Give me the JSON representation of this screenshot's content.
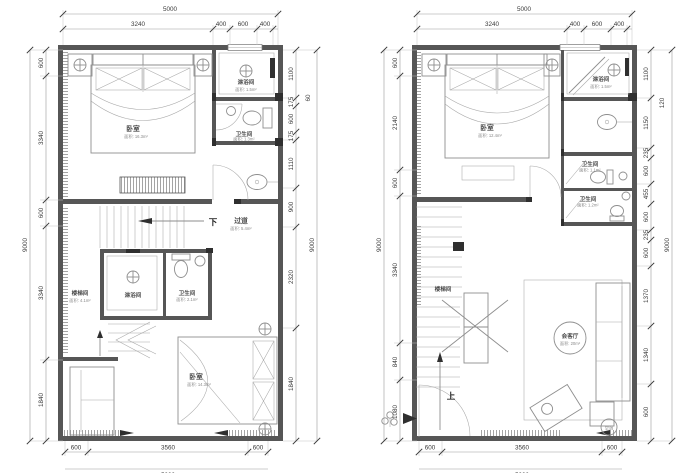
{
  "colors": {
    "wall": "#565656",
    "line": "#8e8e8e",
    "dim_text": "#3a3a3a",
    "background": "#ffffff"
  },
  "left_plan": {
    "dims": {
      "top_total": "5000",
      "top_chain": [
        "3240",
        "400",
        "600",
        "400"
      ],
      "left_total": "9000",
      "left_chain": [
        "600",
        "3340",
        "600",
        "3340",
        "1840"
      ],
      "right_total": "9000",
      "right_wall": "60",
      "right_chain": [
        "1100",
        "175",
        "600",
        "175",
        "1110",
        "900",
        "2320",
        "1840"
      ],
      "bottom_chain": [
        "600",
        "3560",
        "600"
      ],
      "bottom_total": "5000"
    },
    "rooms": {
      "bedroom_top": {
        "name": "卧室",
        "area": "面积: 16.3m²"
      },
      "shower_top": {
        "name": "淋浴间",
        "area": "面积: 1.5m²"
      },
      "bath_top": {
        "name": "卫生间",
        "area": "面积: 1.3m²"
      },
      "corridor": {
        "name": "过道",
        "area": "面积: 5.4m²"
      },
      "stairwell": {
        "name": "楼梯间",
        "area": "面积: 4.1m²"
      },
      "shower_mid": {
        "name": "淋浴间"
      },
      "bath_mid": {
        "name": "卫生间",
        "area": "面积: 2.1m²"
      },
      "bedroom_bottom": {
        "name": "卧室",
        "area": "面积: 14.3m²"
      }
    },
    "labels": {
      "down": "下"
    }
  },
  "right_plan": {
    "dims": {
      "top_total": "5000",
      "top_chain": [
        "3240",
        "400",
        "600",
        "400"
      ],
      "left_total": "9000",
      "left_chain": [
        "600",
        "2140",
        "600",
        "3340",
        "840",
        "1080"
      ],
      "right_total": "9000",
      "right_wall": "120",
      "right_chain": [
        "1100",
        "1150",
        "235",
        "600",
        "455",
        "600",
        "235",
        "600",
        "1370",
        "1340",
        "600"
      ],
      "bottom_chain": [
        "600",
        "3560",
        "600"
      ],
      "bottom_total": "5000"
    },
    "rooms": {
      "bedroom": {
        "name": "卧室",
        "area": "面积: 12.4m²"
      },
      "shower": {
        "name": "淋浴间",
        "area": "面积: 1.5m²"
      },
      "bath_1": {
        "name": "卫生间",
        "area": "面积: 1.1m²"
      },
      "bath_2": {
        "name": "卫生间",
        "area": "面积: 1.2m²"
      },
      "stairwell": {
        "name": "楼梯间"
      },
      "living": {
        "name": "会客厅",
        "area": "面积: 20m²"
      },
      "ac": {
        "name": "空调"
      }
    },
    "labels": {
      "up": "上"
    }
  }
}
